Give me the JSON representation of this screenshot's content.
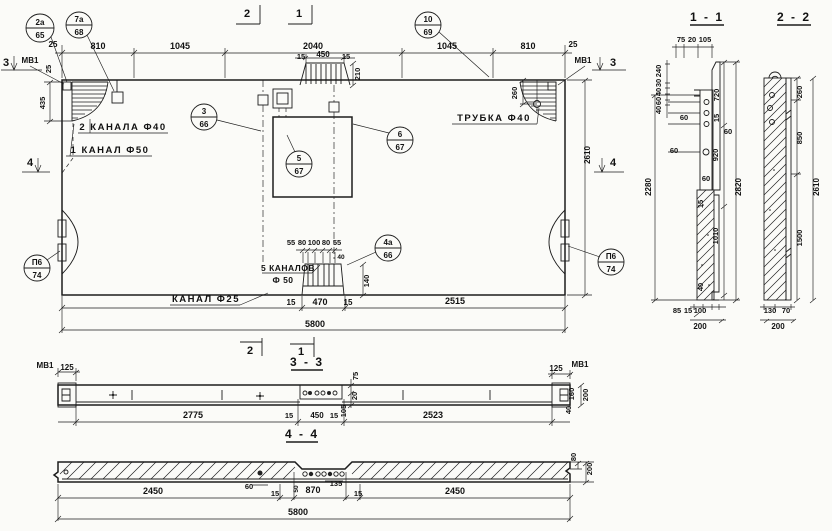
{
  "plan": {
    "top_dims": [
      "25",
      "810",
      "1045",
      "2040",
      "1045",
      "810",
      "25"
    ],
    "detail": {
      "d15l": "15",
      "d450": "450",
      "d15r": "15",
      "d210": "210"
    },
    "left": {
      "m3": "3",
      "mv1": "МВ1",
      "d25": "25",
      "d435": "435",
      "m4": "4"
    },
    "right": {
      "mv1": "МВ1",
      "m3": "3",
      "m4": "4",
      "d2610": "2610",
      "d260": "260"
    },
    "labels": {
      "kanala2": "2 КАНАЛА Ф40",
      "kanal1": "1 КАНАЛ Ф50",
      "trubka": "ТРУБКА Ф40",
      "kanal25": "КАНАЛ Ф25",
      "kanalov5a": "5 КАНАЛОВ",
      "kanalov5b": "Ф 50"
    },
    "block": {
      "d55a": "55",
      "d80a": "80",
      "d100": "100",
      "d80b": "80",
      "d55b": "55",
      "d40": "40",
      "d140": "140"
    },
    "bottom": {
      "d15a": "15",
      "d470": "470",
      "d15b": "15",
      "d2515": "2515",
      "d5800": "5800"
    },
    "markers": {
      "top2": "2",
      "top1": "1",
      "bot2": "2",
      "bot1": "1"
    },
    "callouts": [
      {
        "t": "2а",
        "b": "65"
      },
      {
        "t": "7а",
        "b": "68"
      },
      {
        "t": "10",
        "b": "69"
      },
      {
        "t": "3",
        "b": "66"
      },
      {
        "t": "5",
        "b": "67"
      },
      {
        "t": "6",
        "b": "67"
      },
      {
        "t": "4а",
        "b": "66"
      },
      {
        "t": "П6",
        "b": "74"
      },
      {
        "t": "П6",
        "b": "74"
      }
    ]
  },
  "s11": {
    "title": "1 - 1",
    "top": [
      "75",
      "20",
      "105"
    ],
    "stack": [
      "240",
      "30",
      "40",
      "60",
      "40"
    ],
    "total_l": "2280",
    "total_r": "2820",
    "chain": [
      "720",
      "15",
      "920",
      "15",
      "1010",
      "40"
    ],
    "d60": [
      "60",
      "60",
      "60",
      "60"
    ],
    "bottom": [
      "85",
      "15",
      "100"
    ],
    "d200": "200"
  },
  "s22": {
    "title": "2 - 2",
    "chain": [
      "260",
      "850",
      "1500"
    ],
    "total": "2610",
    "bottom": [
      "130",
      "70"
    ],
    "d200": "200"
  },
  "s33": {
    "title": "3 - 3",
    "mv1_left": "МВ1",
    "d125_left": "125",
    "bottom": [
      "2775",
      "15",
      "450",
      "15",
      "2523"
    ],
    "thick": [
      "75",
      "20",
      "105"
    ],
    "d125_right": "125",
    "mv1_right": "МВ1",
    "right": [
      "160",
      "40",
      "200"
    ]
  },
  "s44": {
    "title": "4 - 4",
    "dims": [
      "2450",
      "60",
      "15",
      "870",
      "135",
      "15",
      "2450"
    ],
    "d50": "50",
    "d5800": "5800",
    "right": [
      "80",
      "200"
    ]
  }
}
